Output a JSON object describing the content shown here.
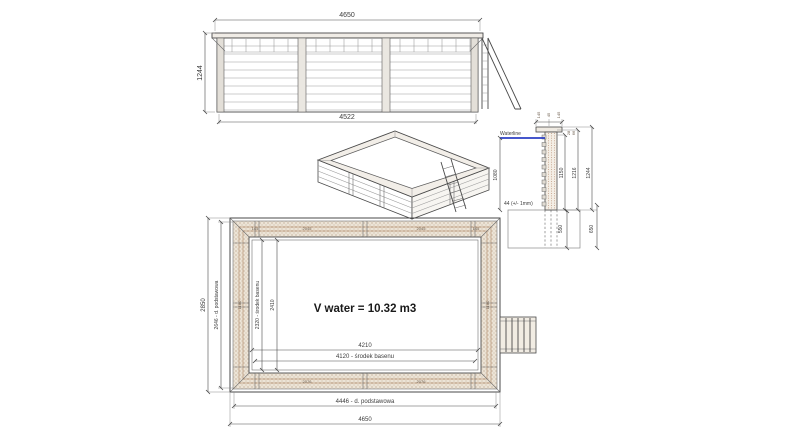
{
  "elevation": {
    "dim_top": "4650",
    "dim_left": "1244",
    "dim_bottom": "4522"
  },
  "section": {
    "waterline_label": "Waterline",
    "dim_water_depth": "1080",
    "dim_wall_thickness": "44 (+/- 1mm)",
    "dim_height_inner": "1150",
    "dim_height_planks": "1216",
    "dim_height_total": "1244",
    "dim_cap_left": "145",
    "dim_cap_mid": "45",
    "dim_cap_right": "145",
    "dim_small_a": "28",
    "dim_small_b": "66",
    "dim_foundation_inner": "550",
    "dim_foundation_outer": "650"
  },
  "plan": {
    "volume_label": "V water = 10.32 m3",
    "dim_outer_width": "2850",
    "dim_base_width": "2646 - d. podstawowa",
    "dim_center_width": "2320 - środek basenu",
    "dim_inner_width": "2410",
    "dim_inner_length": "4210",
    "dim_center_length": "4120 - środek basenu",
    "dim_base_length": "4446 - d. podstawowa",
    "dim_outer_length": "4650",
    "seg_top": "2045",
    "seg_bottom": "2076",
    "seg_side": "1180",
    "corner_post": "145"
  },
  "colors": {
    "waterline": "#2b3fc4",
    "wood_light": "#ece4d7",
    "wood_dot": "#dccfbe",
    "wood_accent": "#a1744f",
    "line": "#4a4a4a"
  }
}
